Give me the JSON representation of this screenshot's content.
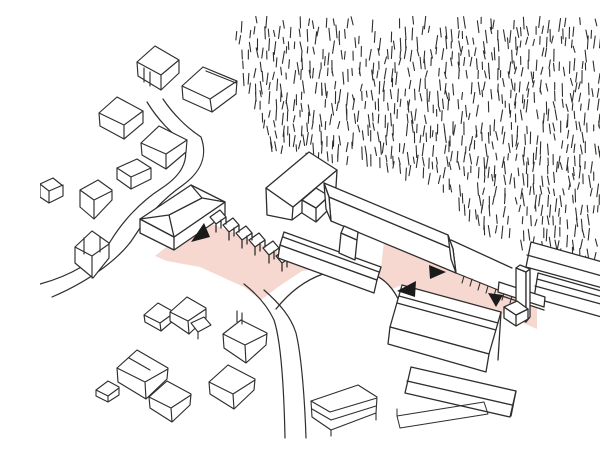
{
  "canvas": {
    "viewBox": "0 0 600 424",
    "width": 600,
    "height": 424,
    "background": "#ffffff"
  },
  "palette": {
    "ink": "#2f2e2c",
    "pink": "#f6d8d1",
    "paper": "#ffffff",
    "arrow": "#1a1a1a"
  },
  "hatch": {
    "note": "forest-hatching",
    "polygon": [
      [
        193,
        0
      ],
      [
        600,
        0
      ],
      [
        600,
        263
      ],
      [
        543,
        247
      ],
      [
        498,
        229
      ],
      [
        452,
        218
      ],
      [
        421,
        186
      ],
      [
        389,
        161
      ],
      [
        330,
        142
      ],
      [
        260,
        138
      ],
      [
        231,
        129
      ],
      [
        202,
        60
      ]
    ],
    "x0": 190,
    "x1": 600,
    "y0": 2,
    "y1": 266,
    "dx": 6.5,
    "dy": 10.5,
    "skip": 0.2,
    "minLen": 6,
    "maxLen": 13,
    "seed": 42,
    "width": 1.1
  },
  "shapes": [
    {
      "name": "plaza-pink-area",
      "d": "M115,240 L150,212 L165,205 L237,235 L239,242 L334,276 L338,263 L341,251 L344,226 L416,257 L479,283 L497,292 L497,313 L460,297 L362,269 L352,273 L330,265 L300,249 L262,255 L238,271 L221,284 L204,271 L160,251 L127,245 Z",
      "fill": "pink",
      "stroke": "none"
    },
    {
      "name": "lawn-mound-fill",
      "d": "M236,293 C248,278 263,265 283,258 C301,252 319,252 333,258 C349,265 359,280 364,299 C366,312 366,322 363,332 L358,346 L248,346 Z",
      "fill": "paper",
      "stroke": "none"
    },
    {
      "name": "lawn-mound-arc",
      "d": "M236,293 C248,278 263,265 283,258 C301,252 319,252 333,258 C349,265 359,280 364,299 C366,312 366,322 363,332"
    },
    {
      "name": "road-west-outer",
      "d": "M107,86 C118,104 132,118 144,126 C150,146 140,160 122,172 C100,186 82,206 70,226 C58,244 30,260 0,268",
      "sw": 1.2
    },
    {
      "name": "road-west-inner",
      "d": "M123,83 C133,98 147,112 161,121 C169,143 158,158 143,169 C123,183 106,202 94,221 C82,240 52,264 12,281",
      "sw": 1.2
    },
    {
      "name": "road-south-left",
      "d": "M204,268 C218,279 228,291 234,304 C241,325 244,374 245,422",
      "sw": 1.2
    },
    {
      "name": "road-south-right",
      "d": "M224,274 C240,288 251,301 256,317 C262,342 265,390 266,422",
      "sw": 1.2
    },
    {
      "name": "hip-building-walls",
      "d": "M100,203 L100,217 L134,234 L185,199 L185,186 L134,221 Z M134,221 L134,234",
      "fill": "paper"
    },
    {
      "name": "hip-building-roof",
      "d": "M100,203 L151,169 L185,186 L134,221 Z",
      "fill": "paper"
    },
    {
      "name": "hip-building-ridge-lines",
      "d": "M100,203 L129,199 M134,221 L129,199 M129,199 L162,182 M151,169 L162,182 M185,186 L162,182"
    },
    {
      "name": "shelter-row",
      "d": "M170,201 l10,-7 l6,7 l-10,7 z m6,7 l0,8 m5,-12 l0,8 m5,-11 l0,7 M183,209 l10,-7 l6,7 l-10,7 z m6,7 l0,8 m5,-12 l0,8 m5,-11 l0,7 M196,217 l10,-7 l6,7 l-10,7 z m6,7 l0,8 m5,-12 l0,8 m5,-11 l0,7 M209,224 l10,-7 l6,7 l-10,7 z m6,7 l0,8 m5,-12 l0,8 m5,-11 l0,7 M223,232 l10,-7 l6,7 l-10,7 z m6,7 l0,8 m5,-12 l0,8 m5,-11 l0,7 M236,240 l10,-7 l6,7 l-10,7 z m6,7 l0,8 m5,-12 l0,8 m5,-11 l0,7",
      "fill": "paper"
    },
    {
      "name": "gym-block-walls",
      "d": "M226,172 L227,199 L252,204 L296,171 L297,154 L253,191 Z M253,191 L252,204",
      "fill": "paper"
    },
    {
      "name": "gym-block-roof",
      "d": "M226,172 L269,136 L297,154 L253,191 Z",
      "fill": "paper"
    },
    {
      "name": "link-block-body",
      "d": "M262,184 L262,197 L276,206 L289,193 L289,180 L276,192 Z M276,192 L276,206",
      "fill": "paper"
    },
    {
      "name": "link-block-roof",
      "d": "M262,184 L276,172 L289,180 L276,192 Z",
      "fill": "paper"
    },
    {
      "name": "long-wing-wall",
      "d": "M289,181 L291,205 L416,257 L413,233 Z",
      "fill": "paper"
    },
    {
      "name": "long-wing-roof",
      "d": "M284,167 L408,219 L413,233 L289,181 Z",
      "fill": "paper"
    },
    {
      "name": "long-wing-end-left",
      "d": "M284,167 L286,193 L291,205 L289,181 Z",
      "fill": "paper"
    },
    {
      "name": "long-wing-end-right",
      "d": "M408,219 L413,233 L416,257 L411,243 Z",
      "fill": "paper"
    },
    {
      "name": "court-building-wall",
      "d": "M240,229 L238,242 L334,277 L337,264 Z",
      "fill": "paper"
    },
    {
      "name": "court-building-roof",
      "d": "M244,216 L341,251 L337,264 L240,229 Z",
      "fill": "paper"
    },
    {
      "name": "court-building-roofline",
      "d": "M243,221 L339,256"
    },
    {
      "name": "court-building-stub-body",
      "d": "M301,217 L299,237 L315,244 L317,224 Z",
      "fill": "paper"
    },
    {
      "name": "court-building-stub-roof",
      "d": "M304,210 L318,216 L317,224 L301,217 Z",
      "fill": "paper"
    },
    {
      "name": "path-upper-edge",
      "d": "M411,224 L472,252"
    },
    {
      "name": "path-fence-ticks",
      "d": "M416,257 L478,282 M424,260 l-2,7 M432,263 l-2,7 M440,267 l-2,7 M448,270 l-2,7 M456,273 l-2,7 M464,277 l-2,7 M472,280 l-2,7",
      "sw": 1.1
    },
    {
      "name": "east-slab-upper",
      "d": "M491,226 L584,252 L581,277 L486,251 Z",
      "fill": "paper"
    },
    {
      "name": "east-slab-upper-lines",
      "d": "M487,239 L580,265 M580,265 L581,277"
    },
    {
      "name": "east-slab-lower",
      "d": "M498,257 L593,284 L590,309 L494,282 Z",
      "fill": "paper"
    },
    {
      "name": "east-slab-lower-lines",
      "d": "M495,270 L590,296 M497,263 L591,289"
    },
    {
      "name": "footbridge-slab",
      "d": "M459,266 L505,281 L504,291 L458,276 Z",
      "fill": "paper"
    },
    {
      "name": "footbridge-lower-line",
      "d": "M459,279 L504,294"
    },
    {
      "name": "stair-tower-front",
      "d": "M476,252 L486,256 L486,306 L476,302 Z",
      "fill": "paper"
    },
    {
      "name": "stair-tower-side",
      "d": "M486,256 L490,253 L490,301 L486,306 Z",
      "fill": "paper"
    },
    {
      "name": "stair-tower-top",
      "d": "M476,252 L480,249 L490,253 L486,256 Z",
      "fill": "paper"
    },
    {
      "name": "small-kiosk-body",
      "d": "M464,291 L464,302 L476,310 L488,303 L488,293 L476,299 Z M476,299 L476,310",
      "fill": "paper"
    },
    {
      "name": "small-kiosk-roof",
      "d": "M464,291 L477,285 L488,293 L476,299 Z",
      "fill": "paper"
    },
    {
      "name": "south-building-roof",
      "d": "M362,269 L461,296 L449,338 L350,311 Z",
      "fill": "paper"
    },
    {
      "name": "south-building-rooflines",
      "d": "M357,287 L456,314 M359,280 L458,307"
    },
    {
      "name": "south-building-wall",
      "d": "M350,311 L348,328 L446,356 L449,338 Z",
      "fill": "paper"
    },
    {
      "name": "south-building-end-edge",
      "d": "M461,296 L458,344"
    },
    {
      "name": "south-building-wing",
      "d": "M371,351 L476,375 L470,401 L365,377 Z",
      "fill": "paper"
    },
    {
      "name": "south-building-wing-lines",
      "d": "M367,365 L472,389 M476,375 L471,400"
    },
    {
      "name": "low-pavilion",
      "d": "M271,385 L318,369 L337,381 L336,397 L291,414 L272,401 Z M271,385 L290,396 M290,396 L337,382 M272,393 L291,404 M291,404 L336,390 M291,414 L291,420 M336,397 L336,404",
      "fill": "paper",
      "sw": 1.1
    },
    {
      "name": "ground-slab-sketch",
      "d": "M357,400 L444,386 M360,412 L448,398 M357,400 L360,412 M444,386 L448,398 M357,400 L357,393",
      "sw": 1.0
    },
    {
      "name": "house-nw-1",
      "d": "M97,46 L115,30 L139,44 L139,57 L121,74 L98,60 Z M97,46 L121,59 M121,59 L139,44 M121,59 L121,74 M104,52 L104,66 M110,56 L110,70",
      "fill": "paper",
      "sw": 1.15
    },
    {
      "name": "house-nw-2",
      "d": "M142,70 L163,51 L197,65 L196,78 L172,96 L143,83 Z M142,70 L170,83 M170,83 L197,65 M170,83 L172,96 M163,51 L194,64 M166,55 L196,67",
      "fill": "paper",
      "sw": 1.15
    },
    {
      "name": "house-nw-3",
      "d": "M59,97 L77,81 L103,95 L103,107 L84,123 L60,110 Z M59,97 L84,109 M84,109 L103,95 M84,109 L84,123",
      "fill": "paper",
      "sw": 1.15
    },
    {
      "name": "house-nw-4",
      "d": "M101,127 L119,110 L147,124 L146,136 L126,153 L102,139 Z M101,127 L126,138 M126,138 L147,124 M126,138 L126,153",
      "fill": "paper",
      "sw": 1.15
    },
    {
      "name": "bar-west-1",
      "d": "M77,152 L97,143 L111,152 L111,163 L91,173 L77,163 Z M77,152 L91,161 M91,161 L111,152 M91,161 L91,173",
      "fill": "paper",
      "sw": 1.15
    },
    {
      "name": "bar-west-2",
      "d": "M40,174 L58,164 L72,174 L72,184 L54,203 L40,191 Z M40,174 L54,184 M54,184 L72,175 M54,184 L54,203",
      "fill": "paper",
      "sw": 1.15
    },
    {
      "name": "cross-gable-house",
      "d": "M35,231 L52,215 L69,227 L69,242 L53,262 L35,247 Z M35,231 L52,240 M52,240 L69,228 M52,240 L52,262 M44,222 L44,238 M60,221 L60,236",
      "fill": "paper",
      "sw": 1.15
    },
    {
      "name": "edge-bar-west",
      "d": "M0,168 L13,162 L23,170 L23,180 L9,187 L0,181 Z M0,168 L9,175 M9,175 L23,169 M9,175 L9,187",
      "fill": "paper",
      "sw": 1.15
    },
    {
      "name": "house-sw-1",
      "d": "M104,299 L118,287 L134,296 L134,304 L121,315 L105,306 Z M104,299 L120,307 M120,307 L134,297 M120,307 L121,315",
      "fill": "paper",
      "sw": 1.15
    },
    {
      "name": "house-sw-2",
      "d": "M130,296 L147,281 L166,292 L166,302 L149,318 L130,305 Z M130,296 L148,305 M148,305 L166,293 M148,305 L149,318",
      "fill": "paper",
      "sw": 1.15
    },
    {
      "name": "house-sw-3",
      "d": "M183,318 L201,304 L227,317 L226,329 L206,347 L184,332 Z M183,318 L205,329 M205,329 L227,318 M205,329 L206,347 M197,306 L197,295 M202,308 L202,297",
      "fill": "paper",
      "sw": 1.15
    },
    {
      "name": "shed-sw",
      "d": "M151,307 L164,301 L171,309 L158,316 Z M158,316 L158,323",
      "fill": "paper",
      "sw": 1.1
    },
    {
      "name": "house-sw-4",
      "d": "M77,352 L97,334 L128,352 L127,363 L106,383 L78,366 Z M77,352 L105,366 M105,366 L128,353 M105,366 L106,383 M89,342 L110,354",
      "fill": "paper",
      "sw": 1.15
    },
    {
      "name": "house-sw-5",
      "d": "M109,381 L127,365 L151,378 L150,389 L132,406 L110,392 Z M109,381 L131,392 M131,392 L151,379 M131,392 L132,406",
      "fill": "paper",
      "sw": 1.15
    },
    {
      "name": "house-sw-6",
      "d": "M169,366 L188,349 L215,363 L214,374 L194,393 L170,378 Z M169,366 L193,378 M193,378 L215,364 M193,378 L194,393",
      "fill": "paper",
      "sw": 1.15
    },
    {
      "name": "hut-sw",
      "d": "M56,374 L68,365 L79,371 L79,379 L68,386 L56,380 Z M56,374 L68,380 M68,380 L79,372 M68,380 L68,386",
      "fill": "paper",
      "sw": 1.1
    },
    {
      "name": "flow-arrow-west",
      "d": "M151,226 L164,207 L170,221 Z",
      "fill": "arrow",
      "stroke": "none"
    },
    {
      "name": "flow-arrow-center-left",
      "d": "M357,275 L376,265 L375,281 Z",
      "fill": "arrow",
      "stroke": "none"
    },
    {
      "name": "flow-arrow-center-right",
      "d": "M406,256 L389,249 L390,263 Z",
      "fill": "arrow",
      "stroke": "none"
    },
    {
      "name": "flow-arrow-east-down",
      "d": "M456,291 L448,277 L463,279 Z",
      "fill": "arrow",
      "stroke": "none"
    }
  ]
}
